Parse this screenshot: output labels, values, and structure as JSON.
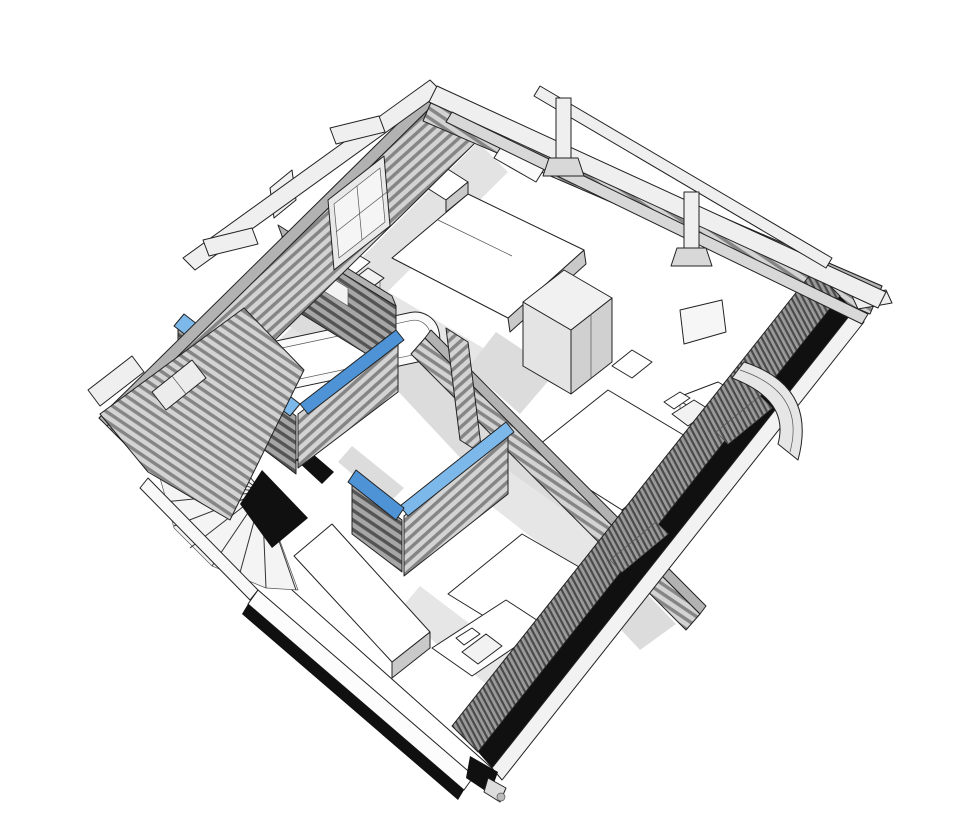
{
  "meta": {
    "type": "3d-architectural-cutaway",
    "description": "Bird's-eye axonometric cutaway of the upper floor of a timber house, plan rotated ~45 degrees, monochrome sketch style with blue highlighted wall tops",
    "floor": "upper floor"
  },
  "colors": {
    "background": "#ffffff",
    "edge": "#222222",
    "wall_top": "#b2b2b2",
    "wall_stripe_light": "#d3d3d3",
    "wall_stripe_dark": "#858585",
    "wall_shadow_stripe_light": "#a6a6a6",
    "wall_shadow_stripe_dark": "#545454",
    "floor": "#ffffff",
    "floor_shadow": "#dcdcdc",
    "highlight_top": "#7db8ea",
    "highlight_side": "#4e93d6",
    "void": "#101010",
    "furniture": "#ffffff",
    "furniture_side": "#c9c9c9",
    "beam": "#efefef",
    "beam_side": "#d8d8d8",
    "fixture": "#fafafa"
  },
  "scene": {
    "rooms": [
      {
        "name": "bedroom-north",
        "furniture": [
          "double-bed",
          "nightstand",
          "chair"
        ]
      },
      {
        "name": "bedroom-east",
        "furniture": [
          "bed",
          "wardrobe",
          "nightstand",
          "desk",
          "chair",
          "wall-frame"
        ]
      },
      {
        "name": "bedroom-south",
        "furniture": [
          "bed",
          "sideboard",
          "desk",
          "chair"
        ]
      },
      {
        "name": "bathroom",
        "fixtures": [
          "bathtub",
          "toilet"
        ]
      },
      {
        "name": "stair-hall",
        "features": [
          "winder-staircase",
          "stairwell-void",
          "railing"
        ]
      },
      {
        "name": "open-terrace",
        "features": [
          "roof-posts",
          "perimeter-beams",
          "rafter"
        ]
      }
    ],
    "highlighted_walls": [
      {
        "id": "bathroom-corner-walls",
        "shape": "L",
        "color": "#7db8ea"
      },
      {
        "id": "closet-corner-walls",
        "shape": "L",
        "color": "#7db8ea"
      }
    ],
    "structure": [
      "log-striped-walls",
      "gable-wall-west",
      "roof-purlin-stubs",
      "eaves-fascia",
      "curved-balcony-bay-east",
      "cut-section-edges"
    ]
  }
}
